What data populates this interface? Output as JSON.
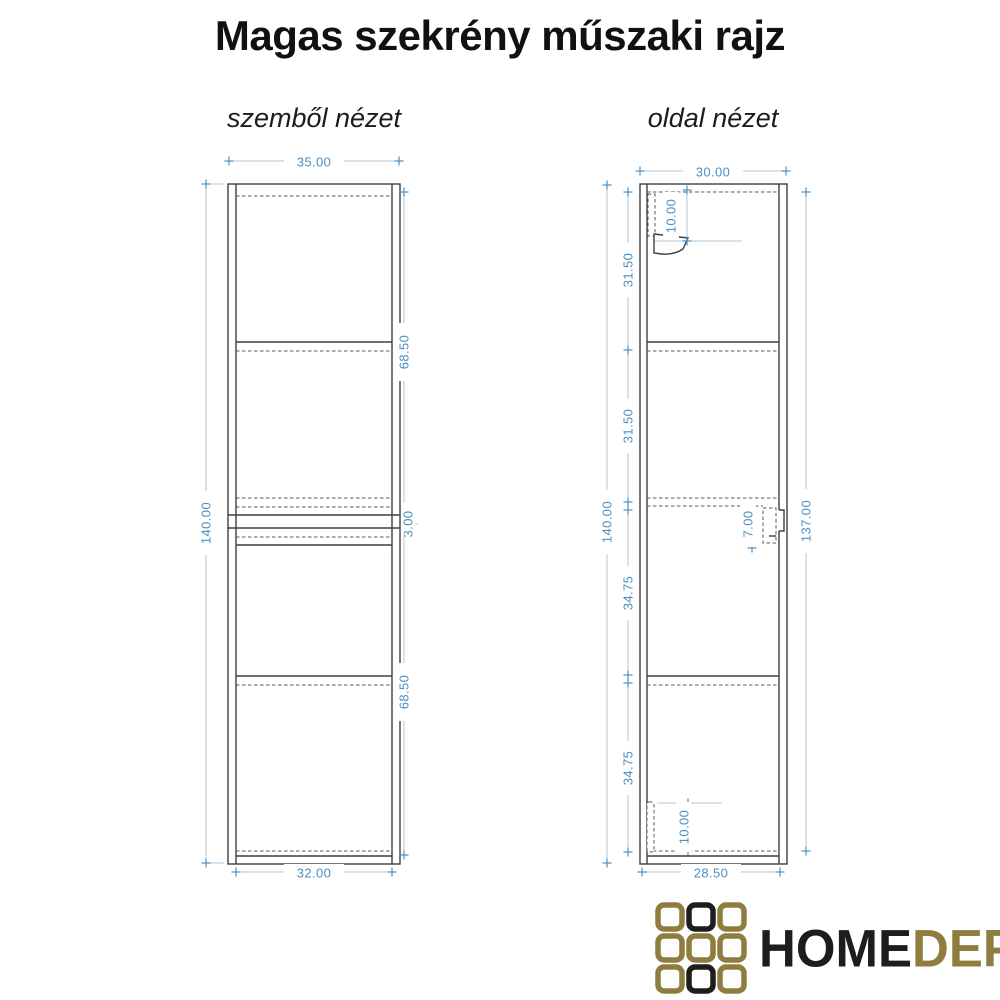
{
  "title": "Magas szekrény műszaki rajz",
  "front_view": {
    "label": "szemből nézet",
    "dims": {
      "outer_width": "35.00",
      "height": "140.00",
      "upper_section_height": "68.50",
      "middle_gap": "3.00",
      "lower_section_height": "68.50",
      "inner_width": "32.00"
    }
  },
  "side_view": {
    "label": "oldal nézet",
    "dims": {
      "outer_depth": "30.00",
      "height": "140.00",
      "top_section": "31.50",
      "second_section": "31.50",
      "third_section": "34.75",
      "bottom_section": "34.75",
      "door_height": "137.00",
      "top_bracket_offset": "10.00",
      "handle_recess": "7.00",
      "bottom_bracket_offset": "10.00",
      "inner_depth": "28.50"
    }
  },
  "logo": {
    "text_home": "HOME",
    "text_depo": "DEPO",
    "grid": [
      "#8e7d3e",
      "#1d1d1b",
      "#8e7d3e",
      "#8e7d3e",
      "#8e7d3e",
      "#8e7d3e",
      "#8e7d3e",
      "#1d1d1b",
      "#8e7d3e"
    ],
    "gold": "#8e7d3e",
    "black": "#1d1d1b"
  },
  "colors": {
    "dimension_text": "#4a90c2",
    "dimension_line": "#b2c9da",
    "drawing_line": "#3f3f3f",
    "background": "#ffffff"
  }
}
